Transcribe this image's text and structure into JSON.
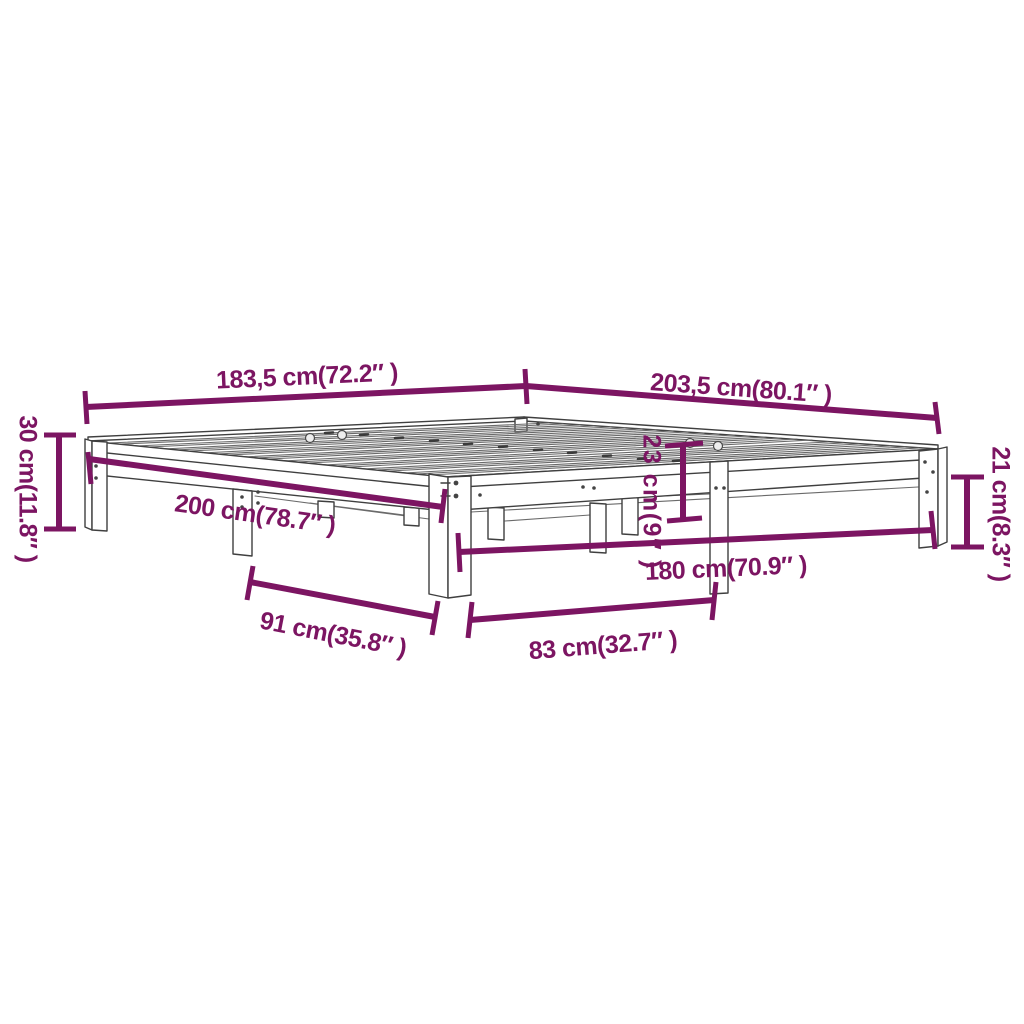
{
  "colors": {
    "dimension": "#7c1562",
    "line": "#3f3f3f",
    "background": "#ffffff"
  },
  "dimensions": {
    "d183": {
      "text": "183,5 cm(72.2″ )"
    },
    "d203": {
      "text": "203,5 cm(80.1″ )"
    },
    "d30": {
      "text": "30 cm(11.8″ )"
    },
    "d200": {
      "text": "200 cm(78.7″ )"
    },
    "d23": {
      "text": "23 cm(9″ )"
    },
    "d21": {
      "text": "21 cm(8.3″ )"
    },
    "d180": {
      "text": "180 cm(70.9″ )"
    },
    "d91": {
      "text": "91 cm(35.8″ )"
    },
    "d83": {
      "text": "83 cm(32.7″ )"
    }
  }
}
